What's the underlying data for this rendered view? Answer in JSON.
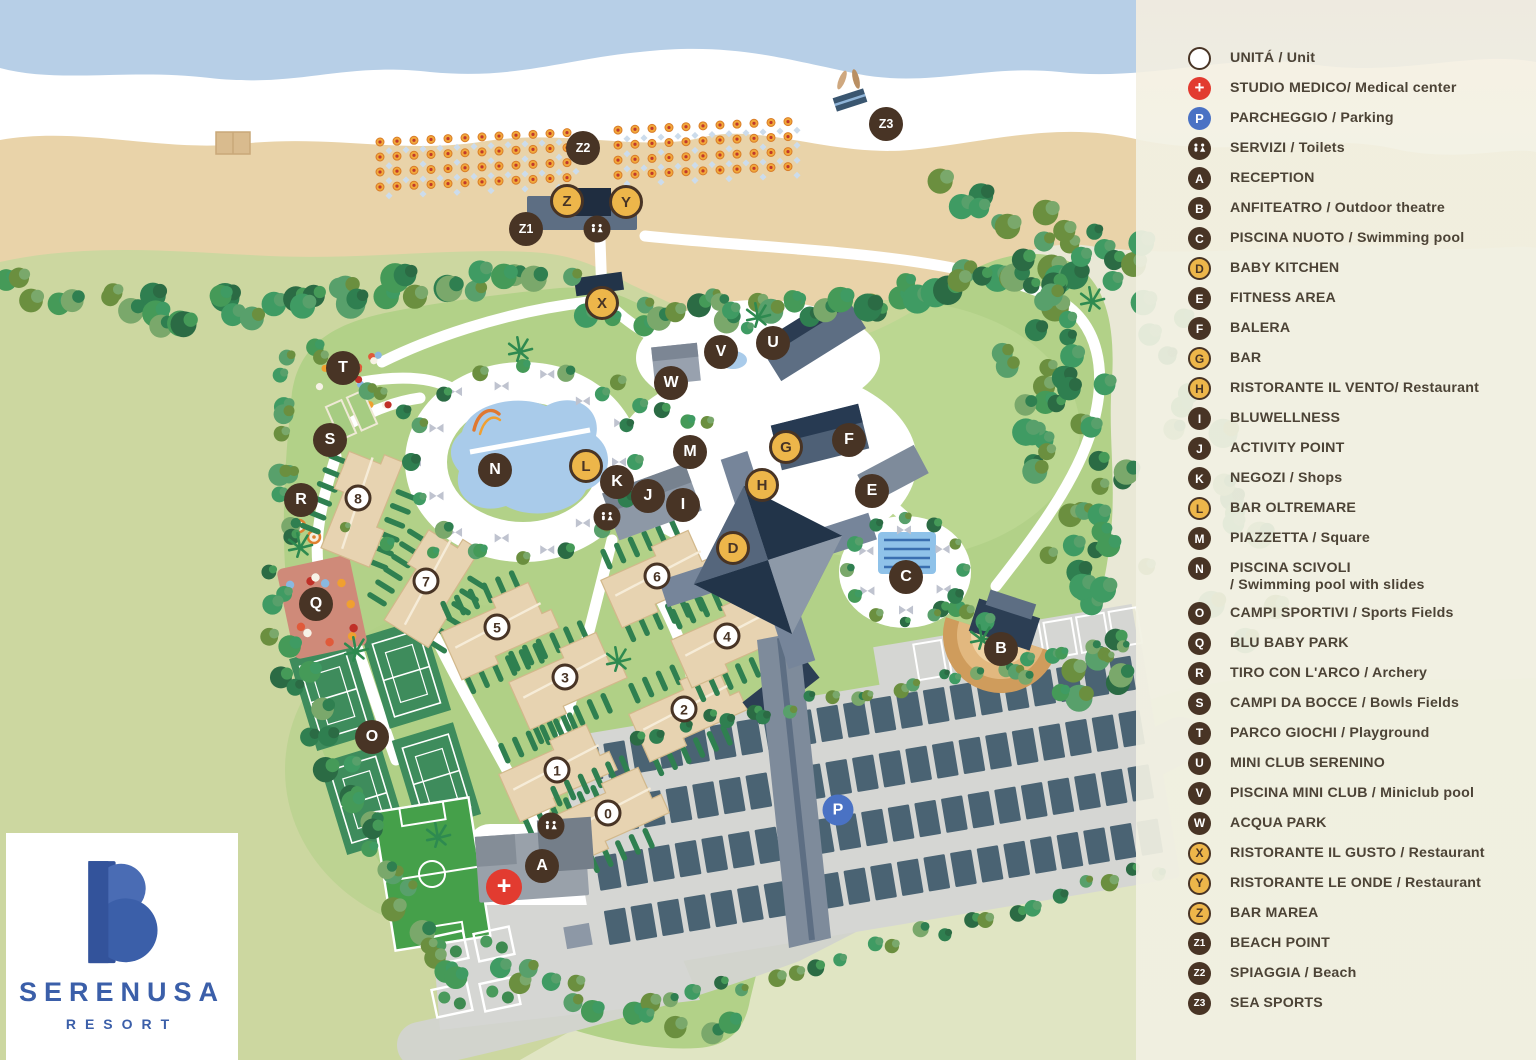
{
  "logo": {
    "brand": "SERENUSA",
    "subtitle": "RESORT",
    "brand_color": "#3b5fa9"
  },
  "colors": {
    "marker_dark": "#483425",
    "marker_gold": "#edb64a",
    "marker_red": "#e23b30",
    "marker_blue": "#4a72c4",
    "legend_bg": "#f0efe1",
    "legend_text": "#4c4336",
    "sea": "#b7cfe7",
    "sand": "#e9d3a9",
    "resort_green": "#b2d188"
  },
  "legend": {
    "items": [
      {
        "symbol": "unit",
        "label": "UNITÁ / Unit"
      },
      {
        "symbol": "medical",
        "label": "STUDIO MEDICO/ Medical center"
      },
      {
        "symbol": "parking",
        "label": "PARCHEGGIO / Parking"
      },
      {
        "symbol": "toilets",
        "label": "SERVIZI / Toilets"
      },
      {
        "symbol": "letter",
        "letter": "A",
        "style": "dark",
        "label": "RECEPTION"
      },
      {
        "symbol": "letter",
        "letter": "B",
        "style": "dark",
        "label": "ANFITEATRO / Outdoor theatre"
      },
      {
        "symbol": "letter",
        "letter": "C",
        "style": "dark",
        "label": "PISCINA NUOTO / Swimming pool"
      },
      {
        "symbol": "letter",
        "letter": "D",
        "style": "gold",
        "label": "BABY KITCHEN"
      },
      {
        "symbol": "letter",
        "letter": "E",
        "style": "dark",
        "label": "FITNESS AREA"
      },
      {
        "symbol": "letter",
        "letter": "F",
        "style": "dark",
        "label": "BALERA"
      },
      {
        "symbol": "letter",
        "letter": "G",
        "style": "gold",
        "label": "BAR"
      },
      {
        "symbol": "letter",
        "letter": "H",
        "style": "gold",
        "label": "RISTORANTE IL VENTO/ Restaurant"
      },
      {
        "symbol": "letter",
        "letter": "I",
        "style": "dark",
        "label": "BLUWELLNESS"
      },
      {
        "symbol": "letter",
        "letter": "J",
        "style": "dark",
        "label": "ACTIVITY POINT"
      },
      {
        "symbol": "letter",
        "letter": "K",
        "style": "dark",
        "label": "NEGOZI / Shops"
      },
      {
        "symbol": "letter",
        "letter": "L",
        "style": "gold",
        "label": "BAR OLTREMARE"
      },
      {
        "symbol": "letter",
        "letter": "M",
        "style": "dark",
        "label": "PIAZZETTA / Square"
      },
      {
        "symbol": "letter",
        "letter": "N",
        "style": "dark",
        "label": "PISCINA SCIVOLI",
        "label2": "/ Swimming pool with slides"
      },
      {
        "symbol": "letter",
        "letter": "O",
        "style": "dark",
        "label": "CAMPI SPORTIVI / Sports Fields"
      },
      {
        "symbol": "letter",
        "letter": "Q",
        "style": "dark",
        "label": "BLU BABY PARK"
      },
      {
        "symbol": "letter",
        "letter": "R",
        "style": "dark",
        "label": "TIRO CON L'ARCO / Archery"
      },
      {
        "symbol": "letter",
        "letter": "S",
        "style": "dark",
        "label": "CAMPI DA BOCCE / Bowls Fields"
      },
      {
        "symbol": "letter",
        "letter": "T",
        "style": "dark",
        "label": "PARCO GIOCHI / Playground"
      },
      {
        "symbol": "letter",
        "letter": "U",
        "style": "dark",
        "label": "MINI CLUB SERENINO"
      },
      {
        "symbol": "letter",
        "letter": "V",
        "style": "dark",
        "label": "PISCINA MINI CLUB / Miniclub pool"
      },
      {
        "symbol": "letter",
        "letter": "W",
        "style": "dark",
        "label": "ACQUA PARK"
      },
      {
        "symbol": "letter",
        "letter": "X",
        "style": "gold",
        "label": "RISTORANTE IL GUSTO / Restaurant"
      },
      {
        "symbol": "letter",
        "letter": "Y",
        "style": "gold",
        "label": "RISTORANTE LE ONDE / Restaurant"
      },
      {
        "symbol": "letter",
        "letter": "Z",
        "style": "gold",
        "label": "BAR MAREA"
      },
      {
        "symbol": "letter",
        "letter": "Z1",
        "style": "dark",
        "label": "BEACH POINT"
      },
      {
        "symbol": "letter",
        "letter": "Z2",
        "style": "dark",
        "label": "SPIAGGIA / Beach"
      },
      {
        "symbol": "letter",
        "letter": "Z3",
        "style": "dark",
        "label": "SEA SPORTS"
      }
    ]
  },
  "markers": [
    {
      "label": "Z2",
      "kind": "dark",
      "x": 583,
      "y": 148
    },
    {
      "label": "Z",
      "kind": "gold",
      "x": 567,
      "y": 201
    },
    {
      "label": "Y",
      "kind": "gold",
      "x": 626,
      "y": 202
    },
    {
      "label": "Z1",
      "kind": "dark",
      "x": 526,
      "y": 229
    },
    {
      "label": "",
      "kind": "toilets",
      "x": 597,
      "y": 229
    },
    {
      "label": "X",
      "kind": "gold",
      "x": 602,
      "y": 303
    },
    {
      "label": "Z3",
      "kind": "dark",
      "x": 886,
      "y": 124
    },
    {
      "label": "T",
      "kind": "dark",
      "x": 343,
      "y": 368
    },
    {
      "label": "S",
      "kind": "dark",
      "x": 330,
      "y": 440
    },
    {
      "label": "R",
      "kind": "dark",
      "x": 301,
      "y": 500
    },
    {
      "label": "N",
      "kind": "dark",
      "x": 495,
      "y": 470
    },
    {
      "label": "Q",
      "kind": "dark",
      "x": 316,
      "y": 604
    },
    {
      "label": "W",
      "kind": "dark",
      "x": 671,
      "y": 383
    },
    {
      "label": "V",
      "kind": "dark",
      "x": 721,
      "y": 352
    },
    {
      "label": "U",
      "kind": "dark",
      "x": 773,
      "y": 343
    },
    {
      "label": "M",
      "kind": "dark",
      "x": 690,
      "y": 452
    },
    {
      "label": "L",
      "kind": "gold",
      "x": 586,
      "y": 466
    },
    {
      "label": "K",
      "kind": "dark",
      "x": 617,
      "y": 482
    },
    {
      "label": "J",
      "kind": "dark",
      "x": 648,
      "y": 496
    },
    {
      "label": "I",
      "kind": "dark",
      "x": 683,
      "y": 505
    },
    {
      "label": "",
      "kind": "toilets",
      "x": 607,
      "y": 517
    },
    {
      "label": "G",
      "kind": "gold",
      "x": 786,
      "y": 447
    },
    {
      "label": "H",
      "kind": "gold",
      "x": 762,
      "y": 485
    },
    {
      "label": "D",
      "kind": "gold",
      "x": 733,
      "y": 548
    },
    {
      "label": "F",
      "kind": "dark",
      "x": 849,
      "y": 440
    },
    {
      "label": "E",
      "kind": "dark",
      "x": 872,
      "y": 491
    },
    {
      "label": "C",
      "kind": "dark",
      "x": 906,
      "y": 577
    },
    {
      "label": "B",
      "kind": "dark",
      "x": 1001,
      "y": 649
    },
    {
      "label": "O",
      "kind": "dark",
      "x": 372,
      "y": 737
    },
    {
      "label": "A",
      "kind": "dark",
      "x": 542,
      "y": 866
    },
    {
      "label": "+",
      "kind": "medical",
      "x": 504,
      "y": 887
    },
    {
      "label": "",
      "kind": "toilets",
      "x": 551,
      "y": 826
    },
    {
      "label": "P",
      "kind": "parking",
      "x": 838,
      "y": 810
    },
    {
      "label": "8",
      "kind": "unit",
      "x": 358,
      "y": 498
    },
    {
      "label": "7",
      "kind": "unit",
      "x": 426,
      "y": 581
    },
    {
      "label": "5",
      "kind": "unit",
      "x": 497,
      "y": 627
    },
    {
      "label": "6",
      "kind": "unit",
      "x": 657,
      "y": 576
    },
    {
      "label": "3",
      "kind": "unit",
      "x": 565,
      "y": 677
    },
    {
      "label": "4",
      "kind": "unit",
      "x": 727,
      "y": 636
    },
    {
      "label": "2",
      "kind": "unit",
      "x": 684,
      "y": 709
    },
    {
      "label": "1",
      "kind": "unit",
      "x": 557,
      "y": 770
    },
    {
      "label": "0",
      "kind": "unit",
      "x": 608,
      "y": 813
    }
  ]
}
